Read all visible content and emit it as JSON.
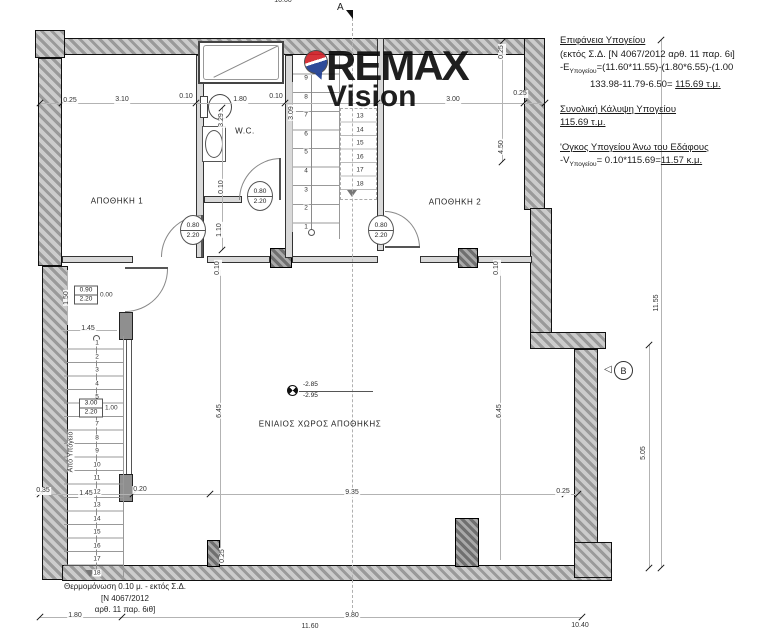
{
  "logo": {
    "brand": "REMAX",
    "sub": "Vision"
  },
  "calc": {
    "lines": [
      {
        "text": "Επιφάνεια Υπογείου",
        "u": true
      },
      {
        "text": "(εκτός Σ.Δ. [Ν 4067/2012 αρθ. 11 παρ. 6ι]"
      },
      {
        "pre": "-E",
        "sub": "Υπογείου",
        "post": "=(11.60*11.55)-(1.80*6.55)-(1.00"
      },
      {
        "indent": true,
        "text": "133.98-11.79-6.50= ",
        "tail": "115.69 τ.μ.",
        "tail_u": true
      },
      {
        "gap": true,
        "text": "Συνολική Κάλυψη Υπογείου",
        "u": true
      },
      {
        "text": "115.69 τ.μ.",
        "u": true
      },
      {
        "gap": true,
        "text": "'Ογκος Υπογείου Άνω του Εδάφους",
        "u": true
      },
      {
        "pre": "-V",
        "sub": "Υπογείου",
        "post": "= 0.10*115.69=",
        "tail": "11.57 κ.μ.",
        "tail_u": true
      }
    ]
  },
  "rooms": [
    {
      "label": "ΑΠΟΘΗΚΗ 1",
      "x": 117,
      "y": 201
    },
    {
      "label": "ΑΠΟΘΗΚΗ 2",
      "x": 455,
      "y": 202
    },
    {
      "label": "W.C.",
      "x": 245,
      "y": 131
    },
    {
      "label": "ΕΝΙΑΙΟΣ ΧΩΡΟΣ ΑΠΟΘΗΚΗΣ",
      "x": 320,
      "y": 424
    }
  ],
  "level_marker": {
    "upper": "-2.85",
    "lower": "-2.95"
  },
  "section_markers": {
    "a": "A",
    "b": "B"
  },
  "door_tags": [
    {
      "top": "0.80",
      "bottom": "2.20",
      "x": 193,
      "y": 230
    },
    {
      "top": "0.80",
      "bottom": "2.20",
      "x": 260,
      "y": 196
    },
    {
      "top": "0.80",
      "bottom": "2.20",
      "x": 381,
      "y": 230
    }
  ],
  "window_tags": [
    {
      "top": "0.90",
      "bottom": "2.20",
      "side": "0.00",
      "x": 86,
      "y": 295
    },
    {
      "top": "3.00",
      "bottom": "2.20",
      "side": "1.00",
      "x": 91,
      "y": 408
    }
  ],
  "stairs": {
    "flight_label": "Από Υπόγειο",
    "upper_left": {
      "x": 306,
      "y0": 78,
      "dy": 18.6,
      "nums": [
        "9",
        "8",
        "7",
        "6",
        "5",
        "4",
        "3",
        "2",
        "1"
      ]
    },
    "upper_right": {
      "x": 360,
      "y0": 116,
      "dy": 13.5,
      "nums": [
        "13",
        "14",
        "15",
        "16",
        "17",
        "18"
      ]
    },
    "lower": {
      "x": 97,
      "y0": 343,
      "dy": 13.5,
      "nums": [
        "1",
        "2",
        "3",
        "4",
        "5",
        "6",
        "7",
        "8",
        "9",
        "10",
        "11",
        "12",
        "13",
        "14",
        "15",
        "16",
        "17",
        "18"
      ]
    }
  },
  "notes": {
    "insulation": [
      "Θερμομόνωση 0.10 μ. - εκτός Σ.Δ.",
      "[Ν 4067/2012",
      "αρθ. 11 παρ. 6ιθ]"
    ]
  },
  "dimensions": [
    {
      "t": "10.00",
      "x": 283,
      "y": 1
    },
    {
      "t": "0.25",
      "x": 70,
      "y": 101
    },
    {
      "t": "3.10",
      "x": 122,
      "y": 100
    },
    {
      "t": "0.10",
      "x": 186,
      "y": 97
    },
    {
      "t": "1.80",
      "x": 240,
      "y": 100
    },
    {
      "t": "0.10",
      "x": 276,
      "y": 97
    },
    {
      "t": "3.00",
      "x": 453,
      "y": 100
    },
    {
      "t": "0.25",
      "x": 520,
      "y": 94
    },
    {
      "t": "0.25",
      "x": 502,
      "y": 52,
      "r": 1
    },
    {
      "t": "4.50",
      "x": 502,
      "y": 147,
      "r": 1
    },
    {
      "t": "3.09",
      "x": 292,
      "y": 113,
      "r": 1
    },
    {
      "t": "3.29",
      "x": 222,
      "y": 120,
      "r": 1
    },
    {
      "t": "0.10",
      "x": 222,
      "y": 187,
      "r": 1
    },
    {
      "t": "1.10",
      "x": 220,
      "y": 230,
      "r": 1
    },
    {
      "t": "0.10",
      "x": 218,
      "y": 268,
      "r": 1
    },
    {
      "t": "0.10",
      "x": 497,
      "y": 268,
      "r": 1
    },
    {
      "t": "1.50",
      "x": 67,
      "y": 298,
      "r": 1
    },
    {
      "t": "1.45",
      "x": 88,
      "y": 329
    },
    {
      "t": "6.45",
      "x": 220,
      "y": 411,
      "r": 1
    },
    {
      "t": "6.45",
      "x": 500,
      "y": 411,
      "r": 1
    },
    {
      "t": "0.35",
      "x": 43,
      "y": 491
    },
    {
      "t": "1.45",
      "x": 86,
      "y": 494
    },
    {
      "t": "0.20",
      "x": 140,
      "y": 490
    },
    {
      "t": "9.35",
      "x": 352,
      "y": 493
    },
    {
      "t": "0.25",
      "x": 563,
      "y": 492
    },
    {
      "t": "0.25",
      "x": 223,
      "y": 556,
      "r": 1
    },
    {
      "t": "11.55",
      "x": 657,
      "y": 303,
      "r": 1
    },
    {
      "t": "5.05",
      "x": 644,
      "y": 453,
      "r": 1
    },
    {
      "t": "1.80",
      "x": 75,
      "y": 616
    },
    {
      "t": "9.80",
      "x": 352,
      "y": 616
    },
    {
      "t": "11.60",
      "x": 310,
      "y": 627
    },
    {
      "t": "10.40",
      "x": 580,
      "y": 626
    }
  ]
}
